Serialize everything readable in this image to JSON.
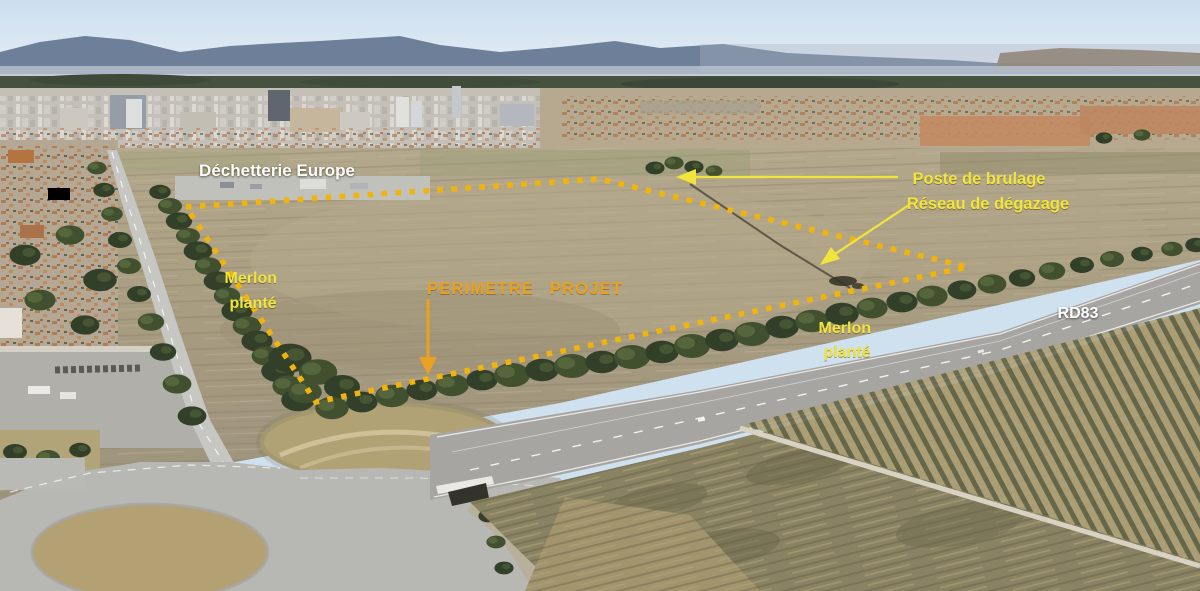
{
  "image_title": "Aerial view of project site",
  "labels": {
    "dechetterie_europe": "Déchetterie Europe",
    "poste_de_brulage": "Poste de brulage",
    "reseau_de_degazage": "Réseau de dégazage",
    "merlon_plante_left": {
      "line1": "Merlon",
      "line2": "planté"
    },
    "perimetre_projet": "PERIMETRE PROJET",
    "merlon_plante_right": {
      "line1": "Merlon",
      "line2": "planté"
    },
    "rd83": "RD83"
  },
  "colors": {
    "annotation_yellow": "#F1E53C",
    "annotation_amber": "#E9A11F",
    "perimeter_dots": "#F2B40A",
    "label_white": "#FFFFFF"
  }
}
